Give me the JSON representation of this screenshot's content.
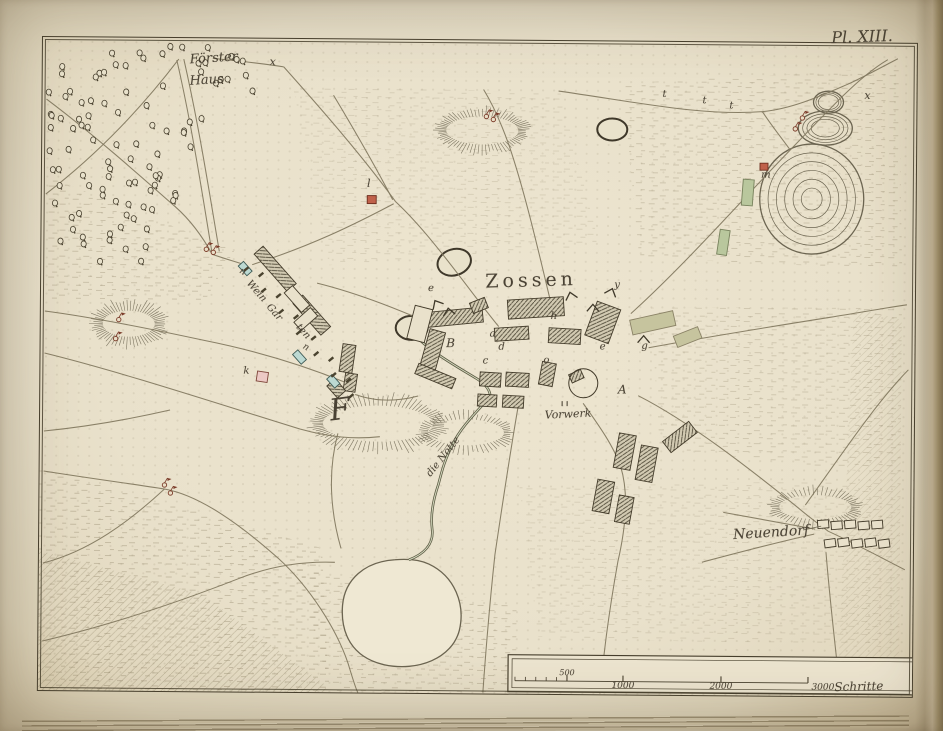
{
  "plate_label": "Pl. XIII.",
  "map_subject": "Zossen",
  "place_names": [
    "Förster Haus",
    "Zossen",
    "Vorwerk",
    "Neuendorf",
    "Weingarten",
    "die Notte"
  ],
  "scale_bar": {
    "tick_values": [
      "500",
      "1000",
      "2000",
      "3000"
    ],
    "unit_label": "Schritte"
  },
  "colors": {
    "ink": "#473f2d",
    "paper": "#ebe3cd",
    "building_teal": "#bcd9d2",
    "building_pink": "#ecc9c4",
    "building_red": "#c0614a",
    "vegetation_green": "#b9c79d",
    "hatch_gray": "#d2cab2"
  },
  "annotations": [
    {
      "id": "plate",
      "text": "Pl. XIII.",
      "x": 862,
      "y": 37,
      "size": 16,
      "rot": -2,
      "italic": true,
      "page": true
    },
    {
      "id": "foerster",
      "text": "Förster",
      "x": 213,
      "y": 56,
      "size": 13,
      "rot": -4,
      "italic": true
    },
    {
      "id": "haus",
      "text": "Haus",
      "x": 206,
      "y": 78,
      "size": 13,
      "rot": -4,
      "italic": true
    },
    {
      "id": "zossen",
      "text": "Zossen",
      "x": 532,
      "y": 276,
      "size": 19,
      "rot": -2,
      "italic": false,
      "spacing": 4
    },
    {
      "id": "vorwerk",
      "text": "Vorwerk",
      "x": 570,
      "y": 409,
      "size": 11,
      "rot": -3,
      "italic": true
    },
    {
      "id": "neuendorf",
      "text": "Neuendorf",
      "x": 774,
      "y": 526,
      "size": 14,
      "rot": -4,
      "italic": true
    },
    {
      "id": "die-notte",
      "text": "die Notte",
      "x": 446,
      "y": 453,
      "size": 10,
      "rot": -52,
      "italic": true
    },
    {
      "id": "wein",
      "text": "Wein",
      "x": 257,
      "y": 289,
      "size": 10,
      "rot": 48,
      "italic": true
    },
    {
      "id": "gar",
      "text": "Gar",
      "x": 275,
      "y": 310,
      "size": 10,
      "rot": 48,
      "italic": true
    },
    {
      "id": "ten",
      "text": "ten",
      "x": 304,
      "y": 329,
      "size": 10,
      "rot": 48,
      "italic": true
    },
    {
      "id": "letter-F",
      "text": "F",
      "x": 342,
      "y": 407,
      "size": 30,
      "rot": -8,
      "italic": true
    },
    {
      "id": "letter-A",
      "text": "A",
      "x": 624,
      "y": 384,
      "size": 12,
      "rot": 0,
      "italic": true
    },
    {
      "id": "letter-B",
      "text": "B",
      "x": 452,
      "y": 339,
      "size": 12,
      "rot": 0,
      "italic": true
    },
    {
      "id": "letter-x-nw",
      "text": "x",
      "x": 272,
      "y": 59,
      "size": 11,
      "rot": 0,
      "italic": true
    },
    {
      "id": "letter-x-ne",
      "text": "x",
      "x": 867,
      "y": 88,
      "size": 11,
      "rot": 0,
      "italic": true
    },
    {
      "id": "letter-t1",
      "text": "t",
      "x": 664,
      "y": 89,
      "size": 10,
      "rot": 0,
      "italic": true
    },
    {
      "id": "letter-t2",
      "text": "t",
      "x": 704,
      "y": 95,
      "size": 10,
      "rot": 0,
      "italic": true
    },
    {
      "id": "letter-t3",
      "text": "t",
      "x": 731,
      "y": 100,
      "size": 10,
      "rot": 0,
      "italic": true
    },
    {
      "id": "letter-l",
      "text": "l",
      "x": 369,
      "y": 180,
      "size": 11,
      "rot": 0,
      "italic": true
    },
    {
      "id": "letter-m",
      "text": "m",
      "x": 766,
      "y": 169,
      "size": 10,
      "rot": 0,
      "italic": true
    },
    {
      "id": "letter-n1",
      "text": "n",
      "x": 243,
      "y": 270,
      "size": 9,
      "rot": 30,
      "italic": true
    },
    {
      "id": "letter-n2",
      "text": "n",
      "x": 307,
      "y": 345,
      "size": 9,
      "rot": 30,
      "italic": true
    },
    {
      "id": "letter-k",
      "text": "k",
      "x": 248,
      "y": 369,
      "size": 10,
      "rot": 0,
      "italic": true
    },
    {
      "id": "letter-e1",
      "text": "e",
      "x": 432,
      "y": 285,
      "size": 10,
      "rot": 0,
      "italic": true
    },
    {
      "id": "letter-a",
      "text": "a",
      "x": 494,
      "y": 330,
      "size": 10,
      "rot": 0,
      "italic": true
    },
    {
      "id": "letter-c",
      "text": "c",
      "x": 487,
      "y": 357,
      "size": 10,
      "rot": 0,
      "italic": true
    },
    {
      "id": "letter-d",
      "text": "d",
      "x": 503,
      "y": 343,
      "size": 10,
      "rot": 0,
      "italic": true
    },
    {
      "id": "letter-o",
      "text": "o",
      "x": 548,
      "y": 356,
      "size": 10,
      "rot": 0,
      "italic": true
    },
    {
      "id": "letter-h",
      "text": "h",
      "x": 555,
      "y": 312,
      "size": 10,
      "rot": 0,
      "italic": true
    },
    {
      "id": "letter-y",
      "text": "y",
      "x": 618,
      "y": 280,
      "size": 10,
      "rot": 0,
      "italic": true
    },
    {
      "id": "letter-e2",
      "text": "e",
      "x": 604,
      "y": 342,
      "size": 10,
      "rot": 0,
      "italic": true
    },
    {
      "id": "letter-g",
      "text": "g",
      "x": 646,
      "y": 341,
      "size": 10,
      "rot": 0,
      "italic": true
    },
    {
      "id": "scale-500",
      "text": "500",
      "x": 571,
      "y": 668,
      "size": 8,
      "rot": 0,
      "italic": true
    },
    {
      "id": "scale-1000",
      "text": "1000",
      "x": 627,
      "y": 681,
      "size": 9,
      "rot": 0,
      "italic": true
    },
    {
      "id": "scale-2000",
      "text": "2000",
      "x": 725,
      "y": 681,
      "size": 9,
      "rot": 0,
      "italic": true
    },
    {
      "id": "scale-3000",
      "text": "3000",
      "x": 827,
      "y": 681,
      "size": 9,
      "rot": 0,
      "italic": true
    },
    {
      "id": "scale-unit",
      "text": "Schritte",
      "x": 863,
      "y": 679,
      "size": 12,
      "rot": -2,
      "italic": true
    }
  ]
}
